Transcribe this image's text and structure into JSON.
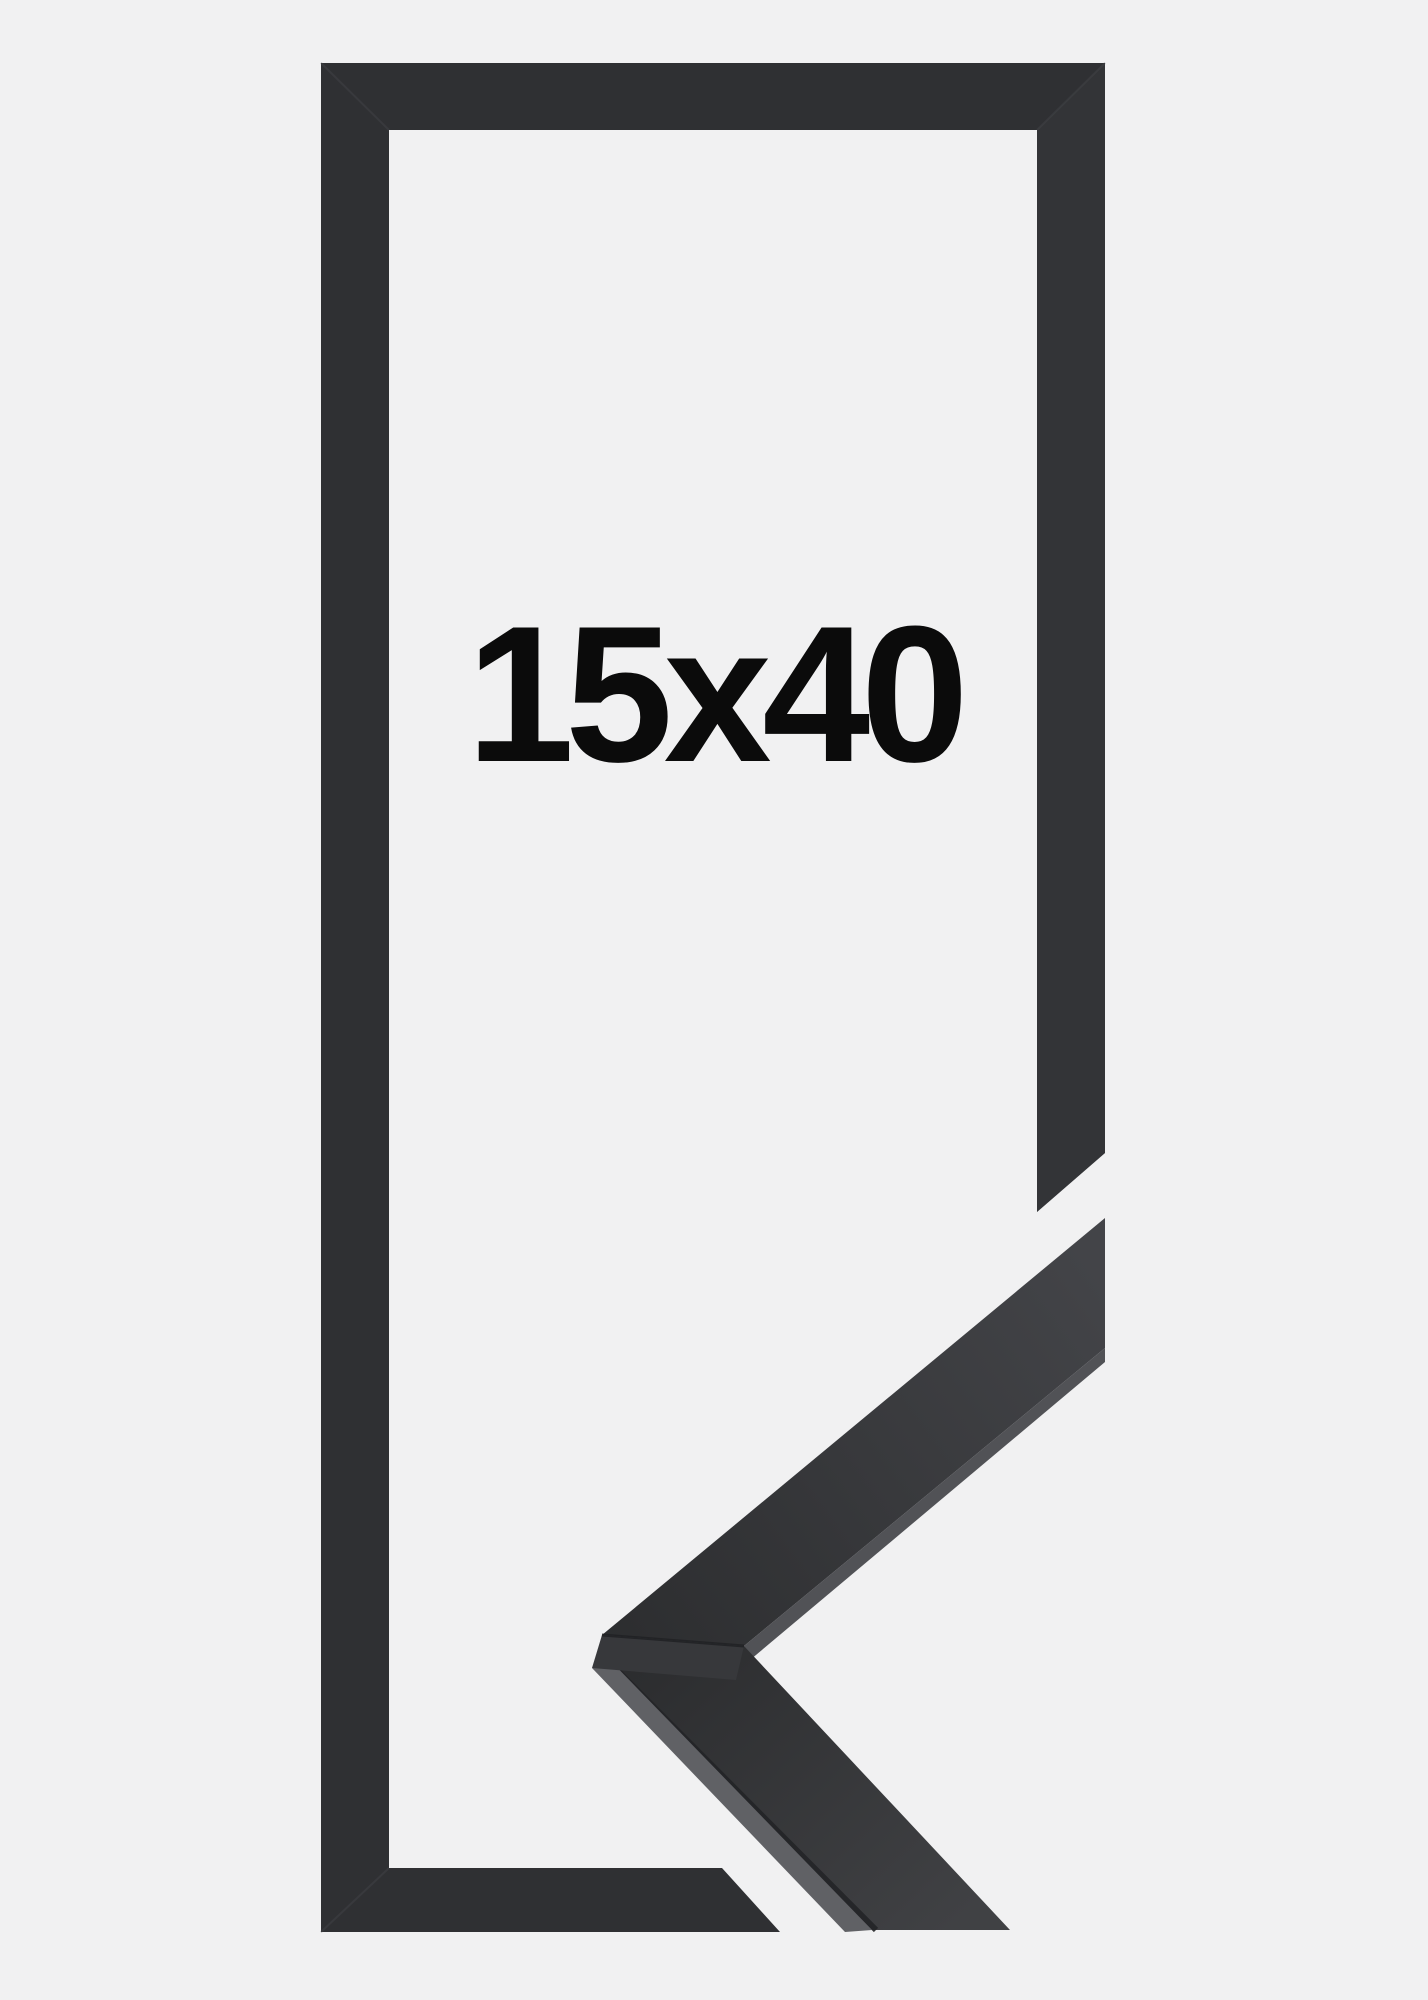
{
  "background_color": "#f1f1f2",
  "product_image": {
    "size_label": "15x40",
    "frame_color": "#2f3033",
    "frame_right_bar_shade": "#37383b",
    "corner_sample_dark": "#2c2d2f",
    "corner_sample_light": "#434448",
    "edge_highlight_color": "#606165",
    "label_color": "#0b0b0b"
  }
}
